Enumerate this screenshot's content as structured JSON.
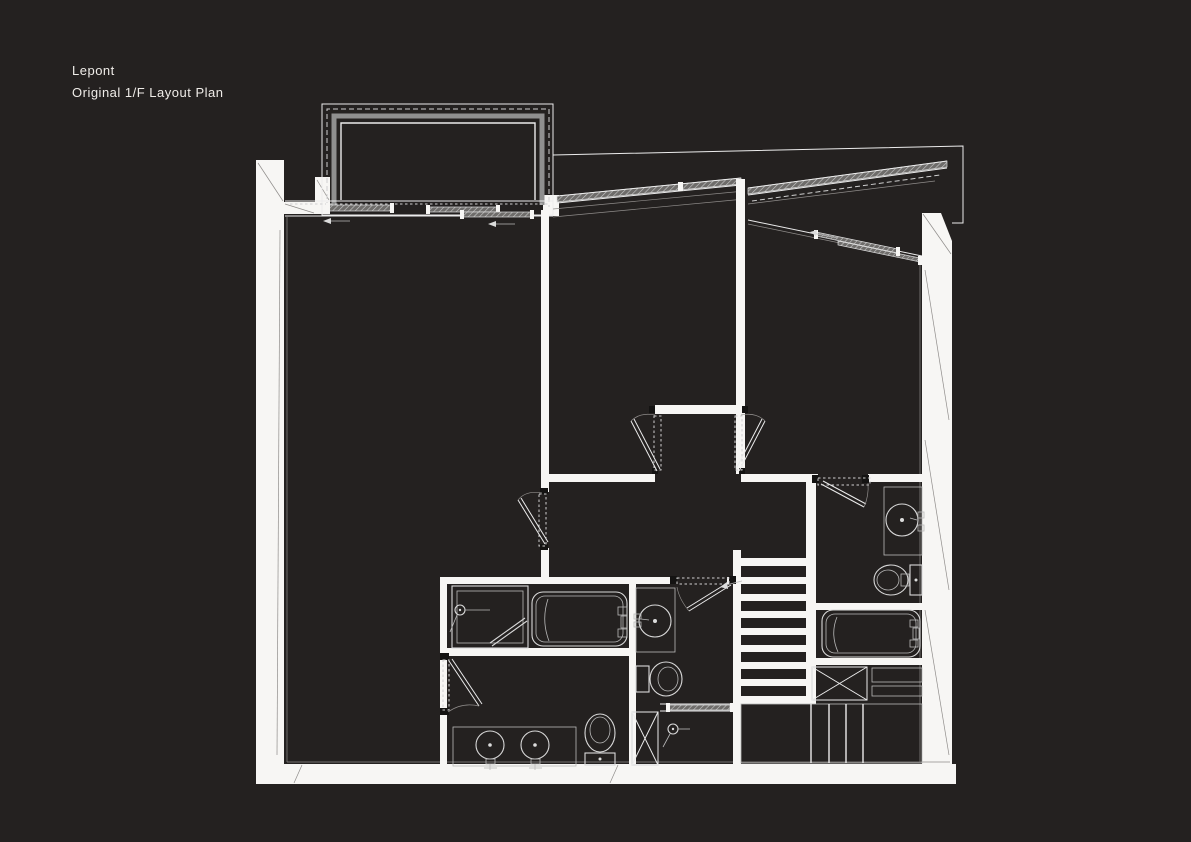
{
  "title": {
    "line1": "Lepont",
    "line2": "Original 1/F Layout Plan"
  },
  "colors": {
    "background": "#242120",
    "wall_fill": "#f7f6f4",
    "line": "#ececec",
    "dim_line": "#8f8c8a",
    "glazing_band": "#8f8f8f",
    "hinge_block": "#141312",
    "title_text": "#efece8"
  },
  "drawing": {
    "type": "architectural-floor-plan",
    "style": "white linework on dark background",
    "visible_elements": {
      "balcony_bay_window": 1,
      "sliding_window_panels": 5,
      "sloped_glazed_wall_segments": 2,
      "swing_doors": 6,
      "sliding_doors": 2,
      "staircase_treads": 8,
      "bathtubs": 2,
      "toilets": 3,
      "round_wash_basins": 4,
      "shower_heads": 3,
      "shower_stall": 1,
      "ventilation_shafts_x_boxes": 2,
      "wardrobe_compartments": 5
    }
  }
}
